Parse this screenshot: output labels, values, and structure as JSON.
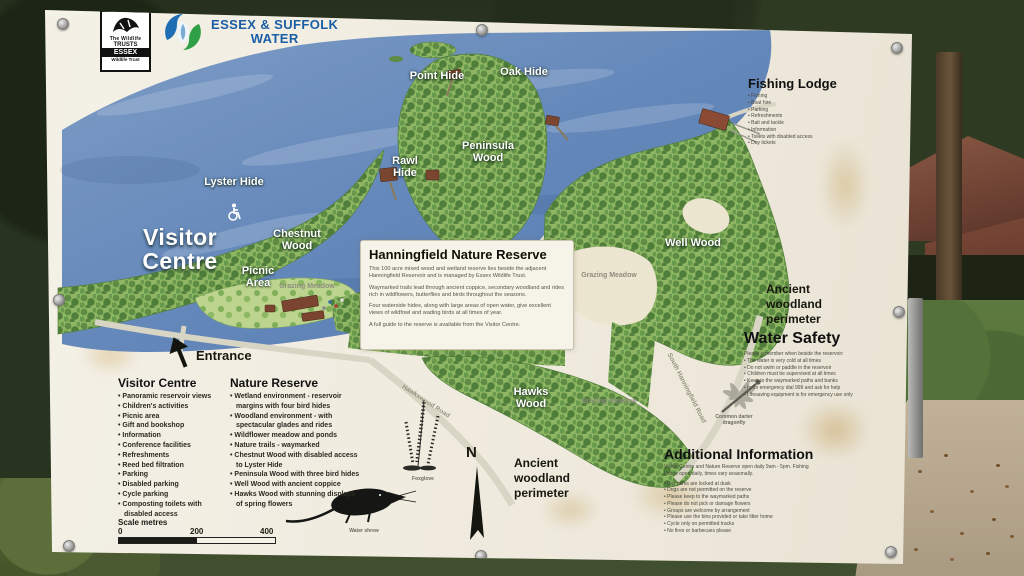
{
  "sign": {
    "logos": {
      "wildlife_trusts": {
        "line1": "The Wildlife",
        "line2": "TRUSTS",
        "region": "ESSEX",
        "sub": "Wildlife Trust"
      },
      "water": {
        "line1": "ESSEX & SUFFOLK",
        "line2": "WATER"
      }
    },
    "map_labels": {
      "point_hide": "Point Hide",
      "oak_hide": "Oak Hide",
      "peninsula_wood": "Peninsula Wood",
      "rawl_hide": "Rawl Hide",
      "lyster_hide": "Lyster Hide",
      "visitor_centre": "Visitor Centre",
      "chestnut_wood": "Chestnut Wood",
      "picnic_area": "Picnic Area",
      "well_wood": "Well Wood",
      "hawks_wood": "Hawks Wood",
      "grazing_meadow": "Grazing Meadow",
      "entrance": "Entrance",
      "ancient_woodland": "Ancient woodland perimeter",
      "north": "N",
      "hawkswood_road": "Hawkswood Road",
      "south_hanningfield_road": "South Hanningfield Road"
    },
    "panel": {
      "title": "Hanningfield Nature Reserve",
      "paragraphs": [
        "This 100 acre mixed wood and wetland reserve lies beside the adjacent Hanningfield Reservoir and is managed by Essex Wildlife Trust.",
        "Waymarked trails lead through ancient coppice, secondary woodland and rides rich in wildflowers, butterflies and birds throughout the seasons.",
        "Four waterside hides, along with large areas of open water, give excellent views of wildfowl and wading birds at all times of year.",
        "A full guide to the reserve is available from the Visitor Centre."
      ]
    },
    "fishing_lodge": {
      "title": "Fishing Lodge",
      "items": [
        "Fishing",
        "Boat hire",
        "Parking",
        "Refreshments",
        "Bait and tackle",
        "Information",
        "Toilets with disabled access",
        "Day tickets"
      ]
    },
    "water_safety": {
      "title": "Water Safety",
      "intro": "Please remember when beside the reservoir:",
      "items": [
        "The water is very cold at all times",
        "Do not swim or paddle in the reservoir",
        "Children must be supervised at all times",
        "Keep to the waymarked paths and banks",
        "In an emergency dial 999 and ask for help",
        "Lifesaving equipment is for emergency use only"
      ]
    },
    "additional_info": {
      "title": "Additional Information",
      "intro": "Visitor Centre and Nature Reserve open daily 9am - 5pm. Fishing Lodge open daily, times vary seasonally.",
      "items": [
        "Car parks are locked at dusk",
        "Dogs are not permitted on the reserve",
        "Please keep to the waymarked paths",
        "Please do not pick or damage flowers",
        "Groups are welcome by arrangement",
        "Please use the bins provided or take litter home",
        "Cycle only on permitted tracks",
        "No fires or barbecues please"
      ]
    },
    "visitor_centre_list": {
      "title": "Visitor Centre",
      "items": [
        "Panoramic reservoir views",
        "Children's activities",
        "Picnic area",
        "Gift and bookshop",
        "Information",
        "Conference facilities",
        "Refreshments",
        "Reed bed filtration",
        "Parking",
        "Disabled parking",
        "Cycle parking",
        "Composting toilets with disabled access"
      ]
    },
    "nature_reserve_list": {
      "title": "Nature Reserve",
      "items": [
        "Wetland environment - reservoir margins with four bird hides",
        "Woodland environment - with spectacular glades and rides",
        "Wildflower meadow and ponds",
        "Nature trails - waymarked",
        "Chestnut Wood with disabled access to Lyster Hide",
        "Peninsula Wood with three bird hides",
        "Well Wood with ancient coppice",
        "Hawks Wood with stunning displays of spring flowers"
      ]
    },
    "scale": {
      "label": "Scale metres",
      "tick0": "0",
      "tick200": "200",
      "tick400": "400"
    },
    "illustrations": {
      "plant_caption": "Foxglove",
      "mammal_caption": "Water shrew",
      "dragonfly_caption": "Common darter dragonfly"
    },
    "colors": {
      "water": "#6488ba",
      "woodland": "#5e8c44",
      "meadow": "#ece5d0",
      "accent_blue": "#1b5ea6",
      "accent_green": "#2fa045"
    }
  }
}
